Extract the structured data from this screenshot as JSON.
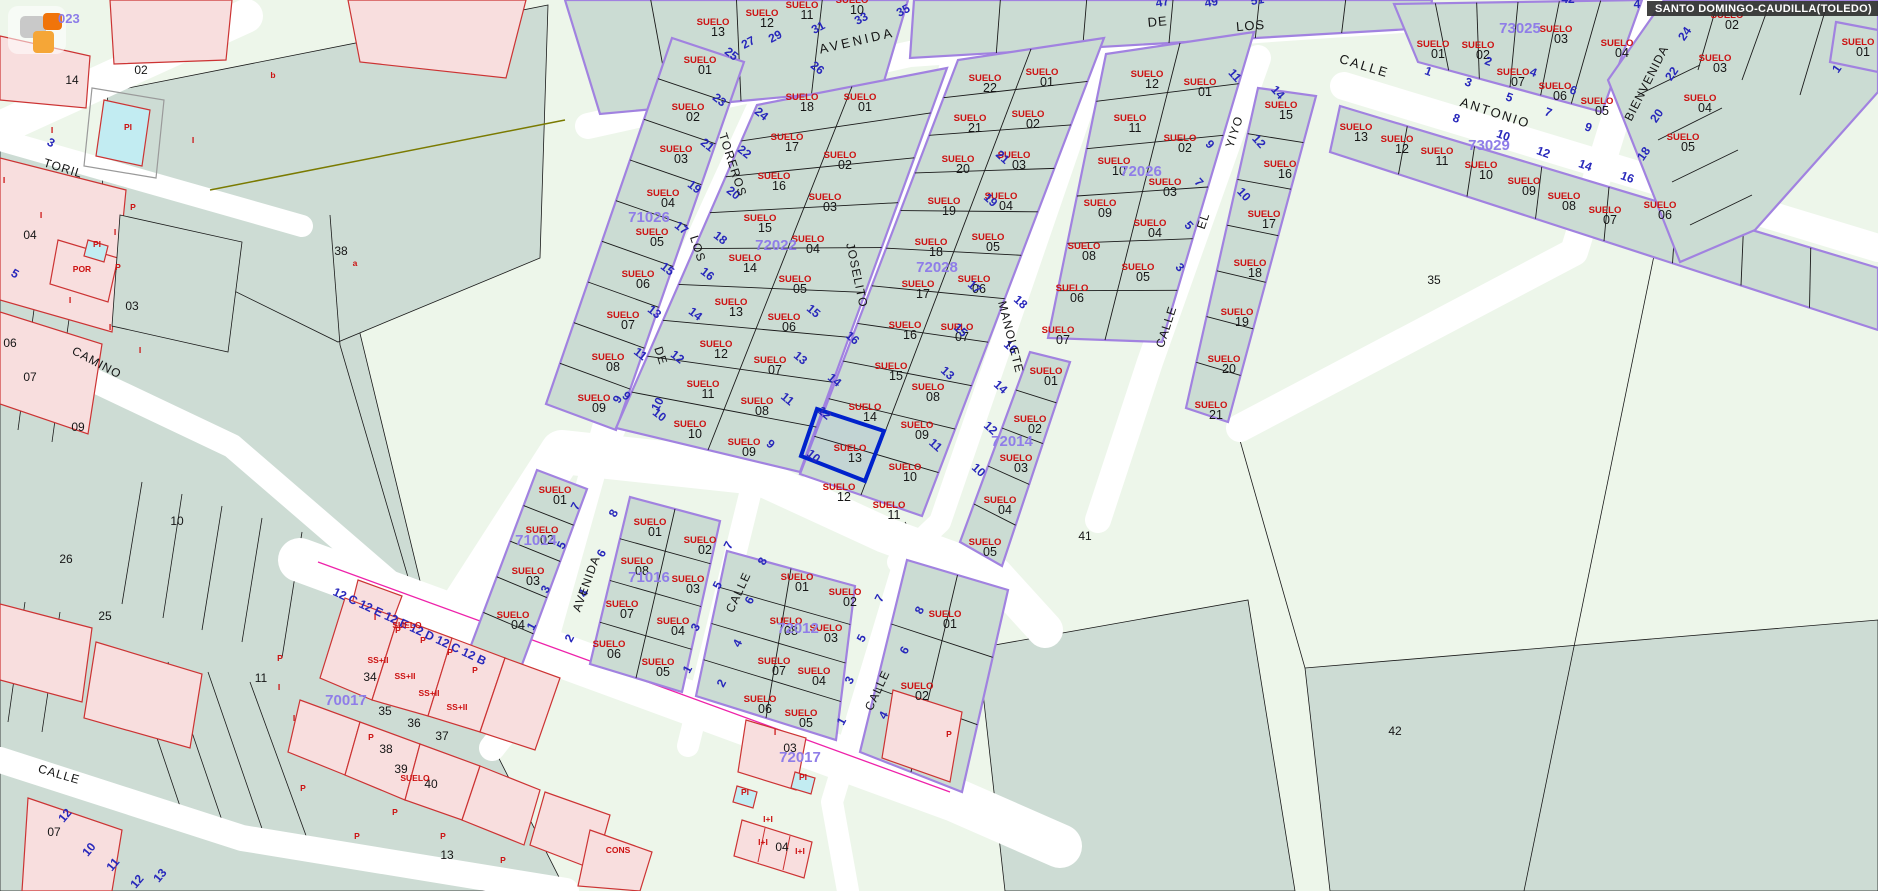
{
  "title_bar": {
    "text": "SANTO DOMINGO-CAUDILLA(TOLEDO)"
  },
  "map_overlay": {
    "partial_block_code": "023"
  },
  "selection": {
    "parcel_label": "SUELO 13"
  },
  "colors": {
    "parcel_fill": "#cbdcd3",
    "rural_fill": "#edf6ea",
    "field_fill": "#cddcd4",
    "block_border": "#a182e0",
    "building_fill": "#f8dede",
    "building_border": "#cc3333",
    "selected_border": "#0022cc",
    "street_number_blue": "#2727bb",
    "suelo_red": "#cc1111",
    "block_id_purple": "#8f7de8",
    "pool_fill": "#c2ecf2",
    "magenta_line": "#ee22aa",
    "title_bar_bg": "#2d2d2d"
  },
  "street_names": [
    [
      "AVENIDA",
      858,
      45,
      -13,
      13,
      3
    ],
    [
      "DE",
      1158,
      26,
      -5,
      13,
      1
    ],
    [
      "LOS",
      1251,
      30,
      -5,
      13,
      1
    ],
    [
      "CALLE",
      1363,
      70,
      17,
      13,
      2
    ],
    [
      "ANTONIO",
      1494,
      117,
      18,
      13,
      2
    ],
    [
      "BIENVENIDA",
      1650,
      85,
      -63,
      12,
      1
    ],
    [
      "YIYO",
      1238,
      133,
      -72,
      12,
      1
    ],
    [
      "EL",
      1207,
      222,
      -72,
      12,
      1
    ],
    [
      "CALLE",
      1170,
      328,
      -72,
      12,
      1
    ],
    [
      "MANOLETE",
      1007,
      338,
      76,
      12,
      1
    ],
    [
      "JOSELITO",
      853,
      276,
      78,
      12,
      1
    ],
    [
      "TOREROS",
      729,
      166,
      72,
      12,
      1
    ],
    [
      "LOS",
      694,
      250,
      72,
      12,
      1
    ],
    [
      "DE",
      657,
      357,
      72,
      12,
      1
    ],
    [
      "TORIL",
      62,
      172,
      17,
      12,
      1
    ],
    [
      "CAMINO",
      95,
      366,
      28,
      12,
      1
    ],
    [
      "CALLE",
      58,
      778,
      16,
      12,
      1
    ],
    [
      "AVENIDA",
      590,
      585,
      -70,
      12,
      1
    ],
    [
      "CALLE",
      742,
      594,
      -65,
      12,
      1
    ],
    [
      "CALLE",
      881,
      692,
      -65,
      12,
      1
    ]
  ],
  "block_ids": [
    [
      "71026",
      649,
      222
    ],
    [
      "72022",
      776,
      250
    ],
    [
      "72028",
      937,
      272
    ],
    [
      "72026",
      1141,
      176
    ],
    [
      "73025",
      1520,
      33
    ],
    [
      "73029",
      1489,
      150
    ],
    [
      "72014",
      1012,
      446
    ],
    [
      "71014",
      536,
      545
    ],
    [
      "71016",
      649,
      582
    ],
    [
      "72012",
      798,
      633
    ],
    [
      "70017",
      346,
      705
    ],
    [
      "72017",
      800,
      762
    ]
  ],
  "suelo_labels": [
    [
      "13",
      713,
      25
    ],
    [
      "12",
      762,
      16
    ],
    [
      "11",
      802,
      8
    ],
    [
      "10",
      852,
      3
    ],
    [
      "01",
      700,
      63
    ],
    [
      "02",
      688,
      110
    ],
    [
      "03",
      676,
      152
    ],
    [
      "04",
      663,
      196
    ],
    [
      "05",
      652,
      235
    ],
    [
      "06",
      638,
      277
    ],
    [
      "07",
      623,
      318
    ],
    [
      "08",
      608,
      360
    ],
    [
      "09",
      594,
      401
    ],
    [
      "18",
      802,
      100
    ],
    [
      "17",
      787,
      140
    ],
    [
      "16",
      774,
      179
    ],
    [
      "15",
      760,
      221
    ],
    [
      "14",
      745,
      261
    ],
    [
      "13",
      731,
      305
    ],
    [
      "12",
      716,
      347
    ],
    [
      "11",
      703,
      387
    ],
    [
      "10",
      690,
      427
    ],
    [
      "01",
      860,
      100
    ],
    [
      "02",
      840,
      158
    ],
    [
      "03",
      825,
      200
    ],
    [
      "04",
      808,
      242
    ],
    [
      "05",
      795,
      282
    ],
    [
      "06",
      784,
      320
    ],
    [
      "07",
      770,
      363
    ],
    [
      "08",
      757,
      404
    ],
    [
      "09",
      744,
      445
    ],
    [
      "22",
      985,
      81
    ],
    [
      "21",
      970,
      121
    ],
    [
      "20",
      958,
      162
    ],
    [
      "19",
      944,
      204
    ],
    [
      "18",
      931,
      245
    ],
    [
      "17",
      918,
      287
    ],
    [
      "16",
      905,
      328
    ],
    [
      "15",
      891,
      369
    ],
    [
      "14",
      865,
      410
    ],
    [
      "13",
      850,
      451
    ],
    [
      "12",
      839,
      490
    ],
    [
      "01",
      1042,
      75
    ],
    [
      "02",
      1028,
      117
    ],
    [
      "03",
      1014,
      158
    ],
    [
      "04",
      1001,
      199
    ],
    [
      "05",
      988,
      240
    ],
    [
      "06",
      974,
      282
    ],
    [
      "07",
      957,
      330
    ],
    [
      "08",
      928,
      390
    ],
    [
      "09",
      917,
      428
    ],
    [
      "10",
      905,
      470
    ],
    [
      "11",
      889,
      508
    ],
    [
      "01",
      1046,
      374
    ],
    [
      "02",
      1030,
      422
    ],
    [
      "03",
      1016,
      461
    ],
    [
      "04",
      1000,
      503
    ],
    [
      "05",
      985,
      545
    ],
    [
      "12",
      1147,
      77
    ],
    [
      "11",
      1130,
      121
    ],
    [
      "10",
      1114,
      164
    ],
    [
      "09",
      1100,
      206
    ],
    [
      "08",
      1084,
      249
    ],
    [
      "06",
      1072,
      291
    ],
    [
      "07",
      1058,
      333
    ],
    [
      "01",
      1200,
      85
    ],
    [
      "02",
      1180,
      141
    ],
    [
      "03",
      1165,
      185
    ],
    [
      "04",
      1150,
      226
    ],
    [
      "05",
      1138,
      270
    ],
    [
      "15",
      1281,
      108
    ],
    [
      "16",
      1280,
      167
    ],
    [
      "17",
      1264,
      217
    ],
    [
      "18",
      1250,
      266
    ],
    [
      "19",
      1237,
      315
    ],
    [
      "20",
      1224,
      362
    ],
    [
      "21",
      1211,
      408
    ],
    [
      "13",
      1356,
      130
    ],
    [
      "12",
      1397,
      142
    ],
    [
      "11",
      1437,
      154
    ],
    [
      "10",
      1481,
      168
    ],
    [
      "09",
      1524,
      184
    ],
    [
      "08",
      1564,
      199
    ],
    [
      "07",
      1605,
      213
    ],
    [
      "07",
      1513,
      75
    ],
    [
      "06",
      1555,
      89
    ],
    [
      "05",
      1597,
      104
    ],
    [
      "01",
      1433,
      47
    ],
    [
      "02",
      1478,
      48
    ],
    [
      "03",
      1556,
      32
    ],
    [
      "04",
      1617,
      46
    ],
    [
      "02",
      1727,
      18
    ],
    [
      "03",
      1715,
      61
    ],
    [
      "04",
      1700,
      101
    ],
    [
      "05",
      1683,
      140
    ],
    [
      "06",
      1660,
      208
    ],
    [
      "01",
      1858,
      45
    ],
    [
      "01",
      555,
      493
    ],
    [
      "02",
      542,
      533
    ],
    [
      "03",
      528,
      574
    ],
    [
      "04",
      513,
      618
    ],
    [
      "01",
      650,
      525
    ],
    [
      "02",
      700,
      543
    ],
    [
      "08",
      637,
      564
    ],
    [
      "03",
      688,
      582
    ],
    [
      "07",
      622,
      607
    ],
    [
      "04",
      673,
      624
    ],
    [
      "06",
      609,
      647
    ],
    [
      "05",
      658,
      665
    ],
    [
      "01",
      797,
      580
    ],
    [
      "02",
      845,
      595
    ],
    [
      "08",
      786,
      624
    ],
    [
      "03",
      826,
      631
    ],
    [
      "07",
      774,
      664
    ],
    [
      "04",
      814,
      674
    ],
    [
      "06",
      760,
      702
    ],
    [
      "05",
      801,
      716
    ],
    [
      "01",
      945,
      617
    ],
    [
      "02",
      917,
      689
    ]
  ],
  "street_numbers": [
    [
      "27",
      750,
      46,
      -28
    ],
    [
      "29",
      777,
      40,
      -28
    ],
    [
      "31",
      820,
      31,
      -28
    ],
    [
      "33",
      863,
      22,
      -28
    ],
    [
      "35",
      905,
      14,
      -28
    ],
    [
      "47",
      1163,
      6,
      -10
    ],
    [
      "49",
      1212,
      6,
      -10
    ],
    [
      "51",
      1258,
      4,
      -10
    ],
    [
      "42",
      1568,
      3,
      0
    ],
    [
      "4",
      1637,
      8,
      0
    ],
    [
      "25",
      729,
      57,
      38
    ],
    [
      "23",
      717,
      103,
      38
    ],
    [
      "21",
      705,
      148,
      38
    ],
    [
      "19",
      692,
      190,
      38
    ],
    [
      "17",
      679,
      231,
      38
    ],
    [
      "15",
      665,
      272,
      38
    ],
    [
      "13",
      652,
      315,
      38
    ],
    [
      "11",
      638,
      357,
      38
    ],
    [
      "9",
      624,
      399,
      38
    ],
    [
      "26",
      815,
      71,
      38
    ],
    [
      "24",
      759,
      117,
      38
    ],
    [
      "22",
      742,
      155,
      38
    ],
    [
      "20",
      731,
      196,
      38
    ],
    [
      "18",
      718,
      241,
      38
    ],
    [
      "16",
      705,
      277,
      38
    ],
    [
      "14",
      693,
      317,
      38
    ],
    [
      "12",
      675,
      360,
      38
    ],
    [
      "10",
      657,
      418,
      38
    ],
    [
      "15",
      811,
      314,
      40
    ],
    [
      "13",
      798,
      361,
      40
    ],
    [
      "11",
      785,
      402,
      40
    ],
    [
      "9",
      768,
      447,
      40
    ],
    [
      "16",
      850,
      341,
      40
    ],
    [
      "14",
      832,
      383,
      40
    ],
    [
      "12",
      822,
      416,
      40
    ],
    [
      "10",
      811,
      459,
      40
    ],
    [
      "21",
      1000,
      160,
      42
    ],
    [
      "19",
      988,
      203,
      42
    ],
    [
      "17",
      972,
      290,
      42
    ],
    [
      "15",
      958,
      333,
      42
    ],
    [
      "13",
      945,
      376,
      42
    ],
    [
      "11",
      933,
      448,
      42
    ],
    [
      "18",
      1018,
      305,
      42
    ],
    [
      "16",
      1008,
      350,
      42
    ],
    [
      "14",
      998,
      390,
      42
    ],
    [
      "12",
      988,
      431,
      42
    ],
    [
      "10",
      976,
      473,
      42
    ],
    [
      "11",
      1232,
      78,
      48
    ],
    [
      "9",
      1207,
      147,
      48
    ],
    [
      "7",
      1196,
      185,
      48
    ],
    [
      "5",
      1186,
      228,
      48
    ],
    [
      "3",
      1177,
      270,
      48
    ],
    [
      "14",
      1275,
      95,
      48
    ],
    [
      "12",
      1256,
      144,
      48
    ],
    [
      "10",
      1241,
      197,
      48
    ],
    [
      "1",
      1427,
      75,
      20
    ],
    [
      "3",
      1467,
      86,
      20
    ],
    [
      "5",
      1508,
      101,
      20
    ],
    [
      "7",
      1547,
      116,
      20
    ],
    [
      "9",
      1587,
      131,
      20
    ],
    [
      "2",
      1487,
      65,
      20
    ],
    [
      "4",
      1532,
      76,
      20
    ],
    [
      "6",
      1572,
      94,
      20
    ],
    [
      "8",
      1455,
      122,
      20
    ],
    [
      "10",
      1502,
      139,
      20
    ],
    [
      "12",
      1542,
      156,
      20
    ],
    [
      "14",
      1584,
      169,
      20
    ],
    [
      "16",
      1626,
      181,
      20
    ],
    [
      "24",
      1688,
      36,
      -55
    ],
    [
      "22",
      1675,
      76,
      -55
    ],
    [
      "20",
      1660,
      118,
      -55
    ],
    [
      "18",
      1647,
      156,
      -55
    ],
    [
      "1",
      1840,
      71,
      -55
    ],
    [
      "10",
      661,
      406,
      -62
    ],
    [
      "8",
      617,
      515,
      -62
    ],
    [
      "6",
      605,
      555,
      -62
    ],
    [
      "4",
      587,
      595,
      -62
    ],
    [
      "2",
      573,
      640,
      -62
    ],
    [
      "9",
      621,
      401,
      -62
    ],
    [
      "7",
      579,
      508,
      -62
    ],
    [
      "5",
      565,
      547,
      -62
    ],
    [
      "3",
      549,
      591,
      -62
    ],
    [
      "1",
      535,
      628,
      -62
    ],
    [
      "7",
      732,
      547,
      -62
    ],
    [
      "5",
      721,
      587,
      -62
    ],
    [
      "3",
      699,
      629,
      -62
    ],
    [
      "1",
      691,
      671,
      -62
    ],
    [
      "8",
      766,
      563,
      -62
    ],
    [
      "6",
      753,
      602,
      -62
    ],
    [
      "4",
      741,
      645,
      -62
    ],
    [
      "2",
      725,
      685,
      -62
    ],
    [
      "7",
      883,
      600,
      -62
    ],
    [
      "5",
      865,
      640,
      -62
    ],
    [
      "3",
      853,
      682,
      -62
    ],
    [
      "1",
      845,
      723,
      -62
    ],
    [
      "8",
      923,
      612,
      -62
    ],
    [
      "6",
      908,
      652,
      -62
    ],
    [
      "4",
      887,
      717,
      -62
    ],
    [
      "12",
      68,
      818,
      -50
    ],
    [
      "10",
      92,
      852,
      -50
    ],
    [
      "11",
      116,
      867,
      -50
    ],
    [
      "12",
      140,
      884,
      -50
    ],
    [
      "13",
      163,
      878,
      -50
    ],
    [
      "3",
      49,
      146,
      30
    ],
    [
      "5",
      13,
      277,
      30
    ],
    [
      "12 C  12 E  12 E  12 D  12 C  12 B",
      408,
      630,
      25,
      "start",
      12
    ]
  ],
  "misc_labels": [
    [
      "14",
      72,
      84,
      "k"
    ],
    [
      "02",
      141,
      74,
      "k"
    ],
    [
      "04",
      30,
      239,
      "k"
    ],
    [
      "03",
      132,
      310,
      "k"
    ],
    [
      "06",
      10,
      347,
      "k"
    ],
    [
      "07",
      30,
      381,
      "k"
    ],
    [
      "09",
      78,
      431,
      "k"
    ],
    [
      "10",
      177,
      525,
      "k"
    ],
    [
      "26",
      66,
      563,
      "k"
    ],
    [
      "25",
      105,
      620,
      "k"
    ],
    [
      "11",
      261,
      682,
      "k"
    ],
    [
      "34",
      370,
      681,
      "k"
    ],
    [
      "35",
      385,
      715,
      "k"
    ],
    [
      "36",
      414,
      727,
      "k"
    ],
    [
      "37",
      442,
      740,
      "k"
    ],
    [
      "38",
      341,
      255,
      "k"
    ],
    [
      "38",
      386,
      753,
      "k"
    ],
    [
      "39",
      401,
      773,
      "k"
    ],
    [
      "40",
      431,
      788,
      "k"
    ],
    [
      "13",
      447,
      859,
      "k"
    ],
    [
      "07",
      54,
      836,
      "k"
    ],
    [
      "35",
      1434,
      284,
      "k"
    ],
    [
      "41",
      1085,
      540,
      "k"
    ],
    [
      "42",
      1395,
      735,
      "k"
    ],
    [
      "03",
      790,
      752,
      "k"
    ],
    [
      "04",
      782,
      851,
      "k"
    ],
    [
      "a",
      355,
      266,
      "r"
    ],
    [
      "b",
      273,
      78,
      "r"
    ],
    [
      "P",
      280,
      661,
      "r"
    ],
    [
      "P",
      398,
      633,
      "r"
    ],
    [
      "P",
      423,
      643,
      "r"
    ],
    [
      "P",
      450,
      655,
      "r"
    ],
    [
      "P",
      475,
      673,
      "r"
    ],
    [
      "I",
      375,
      620,
      "r"
    ],
    [
      "I",
      279,
      690,
      "r"
    ],
    [
      "I",
      294,
      721,
      "r"
    ],
    [
      "I",
      52,
      133,
      "r"
    ],
    [
      "I",
      193,
      143,
      "r"
    ],
    [
      "I",
      4,
      183,
      "r"
    ],
    [
      "I",
      41,
      218,
      "r"
    ],
    [
      "P",
      133,
      210,
      "r"
    ],
    [
      "I",
      115,
      235,
      "r"
    ],
    [
      "PI",
      97,
      247,
      "r"
    ],
    [
      "POR",
      82,
      272,
      "r"
    ],
    [
      "P",
      118,
      270,
      "r"
    ],
    [
      "I",
      70,
      303,
      "r"
    ],
    [
      "I",
      110,
      330,
      "r"
    ],
    [
      "I",
      140,
      353,
      "r"
    ],
    [
      "PI",
      128,
      130,
      "r"
    ],
    [
      "SS+II",
      378,
      663,
      "r"
    ],
    [
      "SS+II",
      405,
      679,
      "r"
    ],
    [
      "SS+II",
      429,
      696,
      "r"
    ],
    [
      "SS+II",
      457,
      710,
      "r"
    ],
    [
      "SUELO",
      407,
      628,
      "r"
    ],
    [
      "SUELO",
      415,
      781,
      "r"
    ],
    [
      "CONS",
      618,
      853,
      "r"
    ],
    [
      "I+I",
      763,
      845,
      "r"
    ],
    [
      "I+I",
      800,
      854,
      "r"
    ],
    [
      "I+I",
      768,
      822,
      "r"
    ],
    [
      "PI",
      745,
      795,
      "r"
    ],
    [
      "PI",
      803,
      780,
      "r"
    ],
    [
      "I",
      775,
      735,
      "r"
    ],
    [
      "P",
      949,
      737,
      "r"
    ],
    [
      "P",
      371,
      740,
      "r"
    ],
    [
      "P",
      395,
      815,
      "r"
    ],
    [
      "P",
      443,
      839,
      "r"
    ],
    [
      "P",
      357,
      839,
      "r"
    ],
    [
      "P",
      503,
      863,
      "r"
    ],
    [
      "P",
      303,
      791,
      "r"
    ]
  ]
}
